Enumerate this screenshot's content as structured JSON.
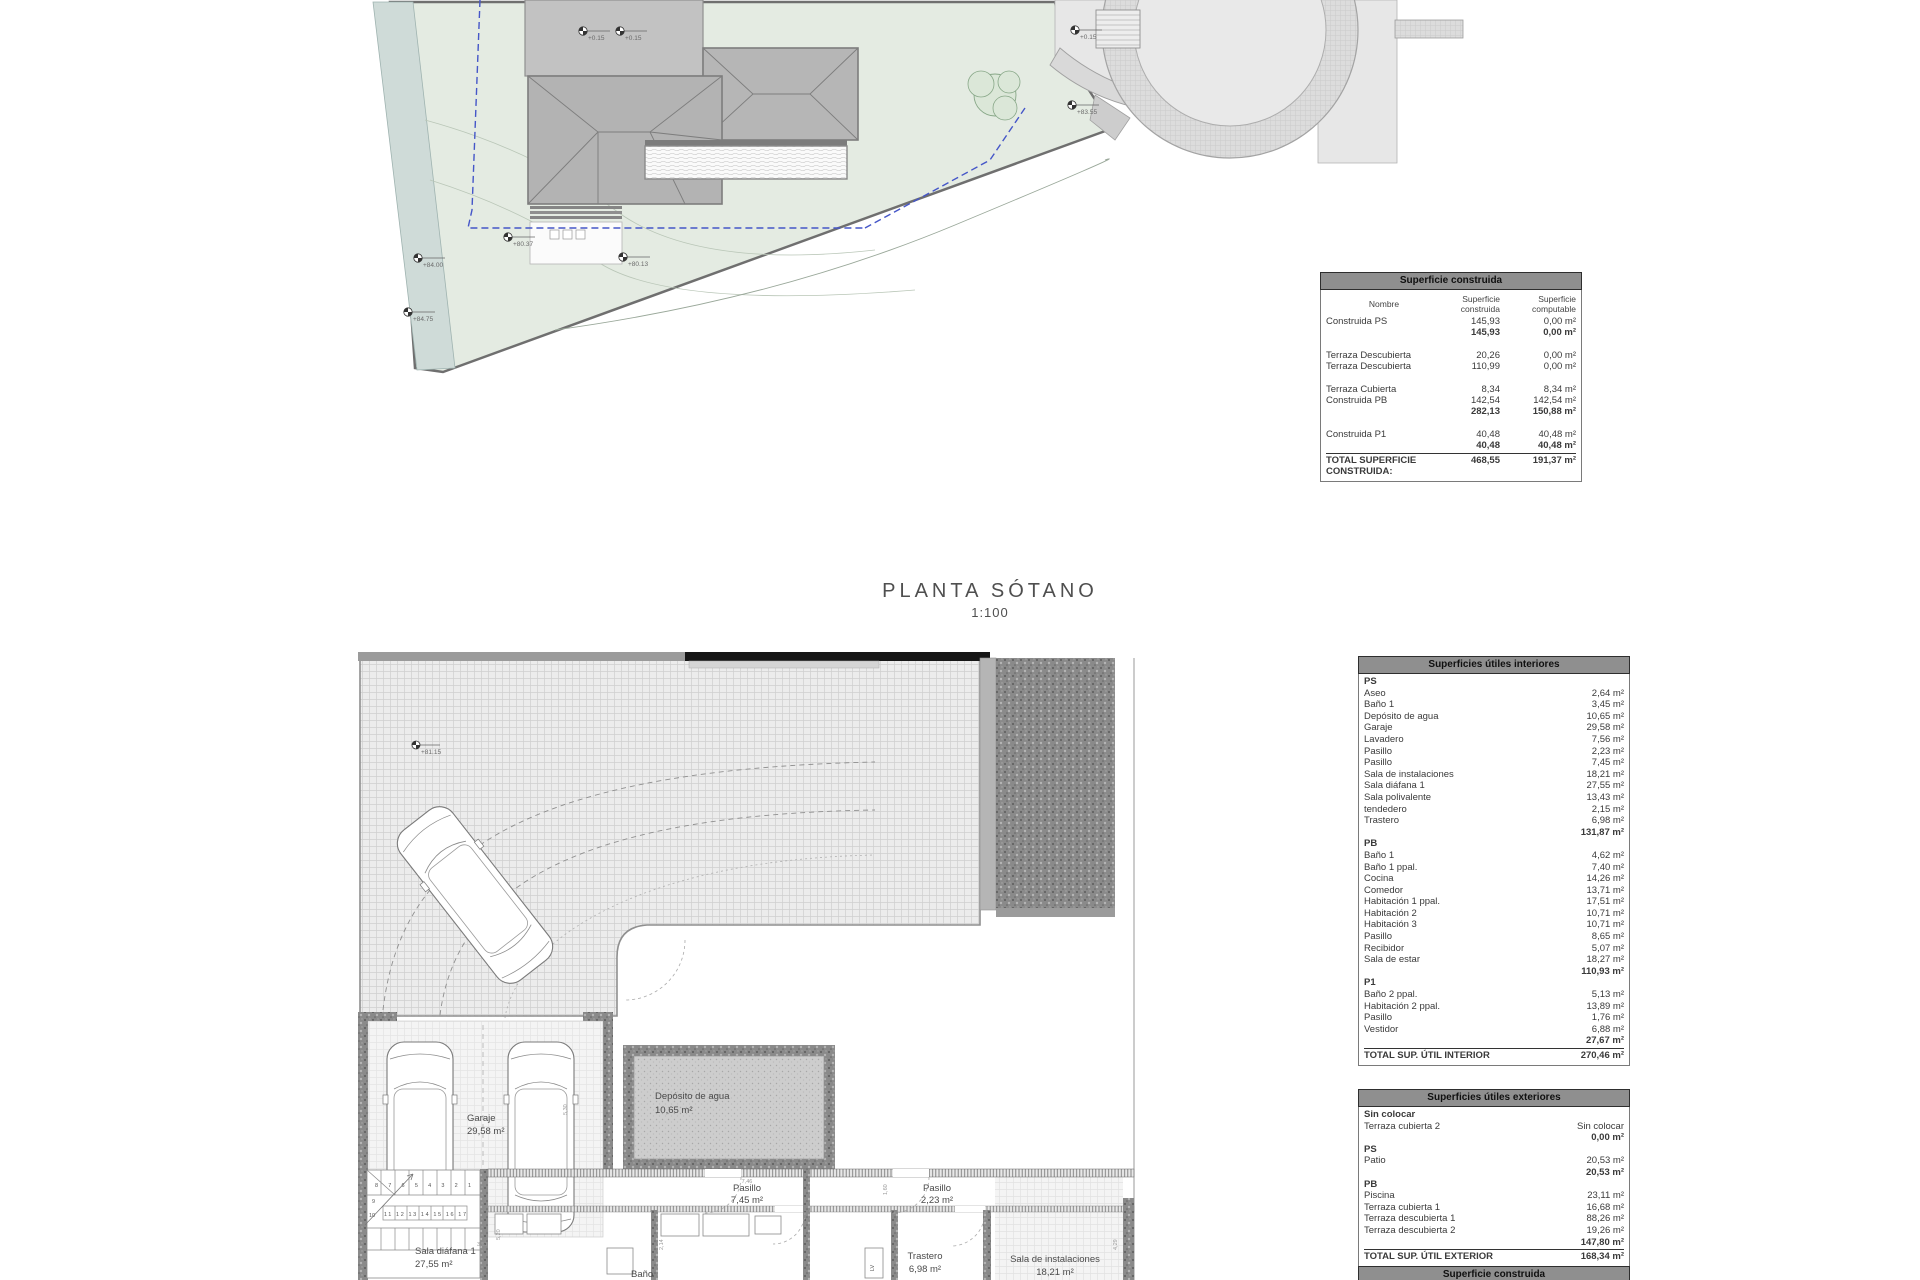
{
  "plan_title": {
    "title": "PLANTA SÓTANO",
    "scale": "1:100"
  },
  "construida_table": {
    "title": "Superficie construida",
    "columns": [
      "Nombre",
      "Superficie construida",
      "Superficie computable"
    ],
    "rows": [
      {
        "label": "Construida PS",
        "sup": "145,93",
        "comp": "0,00 m²"
      },
      {
        "bold": true,
        "label": "",
        "sup": "145,93",
        "comp": "0,00 m²"
      },
      {
        "spacer": true
      },
      {
        "label": "Terraza Descubierta",
        "sup": "20,26",
        "comp": "0,00 m²"
      },
      {
        "label": "Terraza Descubierta",
        "sup": "110,99",
        "comp": "0,00 m²"
      },
      {
        "spacer": true
      },
      {
        "label": "Terraza Cubierta",
        "sup": "8,34",
        "comp": "8,34 m²"
      },
      {
        "label": "Construida PB",
        "sup": "142,54",
        "comp": "142,54 m²"
      },
      {
        "bold": true,
        "label": "",
        "sup": "282,13",
        "comp": "150,88 m²"
      },
      {
        "spacer": true
      },
      {
        "label": "Construida P1",
        "sup": "40,48",
        "comp": "40,48 m²"
      },
      {
        "bold": true,
        "label": "",
        "sup": "40,48",
        "comp": "40,48 m²"
      }
    ],
    "total": {
      "label": "TOTAL SUPERFICIE CONSTRUIDA:",
      "sup": "468,55",
      "comp": "191,37 m²"
    }
  },
  "interior_table": {
    "title": "Superficies útiles interiores",
    "groups": [
      {
        "name": "PS",
        "rows": [
          [
            "Aseo",
            "2,64 m²"
          ],
          [
            "Baño 1",
            "3,45 m²"
          ],
          [
            "Depósito de agua",
            "10,65 m²"
          ],
          [
            "Garaje",
            "29,58 m²"
          ],
          [
            "Lavadero",
            "7,56 m²"
          ],
          [
            "Pasillo",
            "2,23 m²"
          ],
          [
            "Pasillo",
            "7,45 m²"
          ],
          [
            "Sala de instalaciones",
            "18,21 m²"
          ],
          [
            "Sala diáfana 1",
            "27,55 m²"
          ],
          [
            "Sala polivalente",
            "13,43 m²"
          ],
          [
            "tendedero",
            "2,15 m²"
          ],
          [
            "Trastero",
            "6,98 m²"
          ]
        ],
        "subtotal": "131,87 m²"
      },
      {
        "name": "PB",
        "rows": [
          [
            "Baño 1",
            "4,62 m²"
          ],
          [
            "Baño 1 ppal.",
            "7,40 m²"
          ],
          [
            "Cocina",
            "14,26 m²"
          ],
          [
            "Comedor",
            "13,71 m²"
          ],
          [
            "Habitación 1 ppal.",
            "17,51 m²"
          ],
          [
            "Habitación 2",
            "10,71 m²"
          ],
          [
            "Habitación 3",
            "10,71 m²"
          ],
          [
            "Pasillo",
            "8,65 m²"
          ],
          [
            "Recibidor",
            "5,07 m²"
          ],
          [
            "Sala de estar",
            "18,27 m²"
          ]
        ],
        "subtotal": "110,93 m²"
      },
      {
        "name": "P1",
        "rows": [
          [
            "Baño 2 ppal.",
            "5,13 m²"
          ],
          [
            "Habitación 2 ppal.",
            "13,89 m²"
          ],
          [
            "Pasillo",
            "1,76 m²"
          ],
          [
            "Vestidor",
            "6,88 m²"
          ]
        ],
        "subtotal": "27,67 m²"
      }
    ],
    "total": {
      "label": "TOTAL SUP. ÚTIL INTERIOR",
      "value": "270,46 m²"
    }
  },
  "exterior_table": {
    "title": "Superficies útiles exteriores",
    "groups": [
      {
        "name": "Sin colocar",
        "rows": [
          [
            "Terraza cubierta 2",
            "Sin colocar"
          ]
        ],
        "subtotal": "0,00 m²"
      },
      {
        "name": "PS",
        "rows": [
          [
            "Patio",
            "20,53 m²"
          ]
        ],
        "subtotal": "20,53 m²"
      },
      {
        "name": "PB",
        "rows": [
          [
            "Piscina",
            "23,11 m²"
          ],
          [
            "Terraza cubierta 1",
            "16,68 m²"
          ],
          [
            "Terraza descubierta 1",
            "88,26 m²"
          ],
          [
            "Terraza descubierta 2",
            "19,26 m²"
          ]
        ],
        "subtotal": "147,80 m²"
      }
    ],
    "total": {
      "label": "TOTAL SUP. ÚTIL EXTERIOR",
      "value": "168,34 m²"
    }
  },
  "next_table": {
    "title": "Superficie construida"
  },
  "site_plan": {
    "spot_levels": [
      {
        "label": "+84.00"
      },
      {
        "label": "+84.75"
      },
      {
        "label": "+80.37"
      },
      {
        "label": "+80.13"
      },
      {
        "label": "+83.55"
      },
      {
        "label": "+0.15"
      },
      {
        "label": "+0.15"
      },
      {
        "label": "+0.15"
      }
    ],
    "colors": {
      "plot": "#e4ebe2",
      "water": "#cfdbd8",
      "roof_flat": "#c2c2c2",
      "roof_hip": "#b6b6b6",
      "road": "#e7e7e7",
      "road_band": "#d9d9d9",
      "setback_dashed": "#4556c8"
    }
  },
  "basement_plan": {
    "rooms": [
      {
        "name": "Garaje",
        "area": "29,58 m²"
      },
      {
        "name": "Depósito de agua",
        "area": "10,65 m²"
      },
      {
        "name": "Pasillo",
        "area": "7,45 m²"
      },
      {
        "name": "Pasillo",
        "area": "2,23 m²"
      },
      {
        "name": "Trastero",
        "area": "6,98 m²"
      },
      {
        "name": "Sala de instalaciones",
        "area": "18,21 m²"
      },
      {
        "name": "Sala diáfana 1",
        "area": "27,55 m²"
      },
      {
        "name": "Baño",
        "area": ""
      }
    ],
    "stair_numbers_upper": "8 7 6 5 4 3 2 1",
    "stair_numbers_lower": "11 12 13 14 15 16 17",
    "stair_side_a": "9",
    "stair_side_b": "10",
    "appliance_label": "LV",
    "spot_level": "+81.15",
    "dimensions": [
      "7,46",
      "5,20",
      "2,14",
      "1,60",
      "4,29",
      "5,30",
      "3,61"
    ]
  }
}
